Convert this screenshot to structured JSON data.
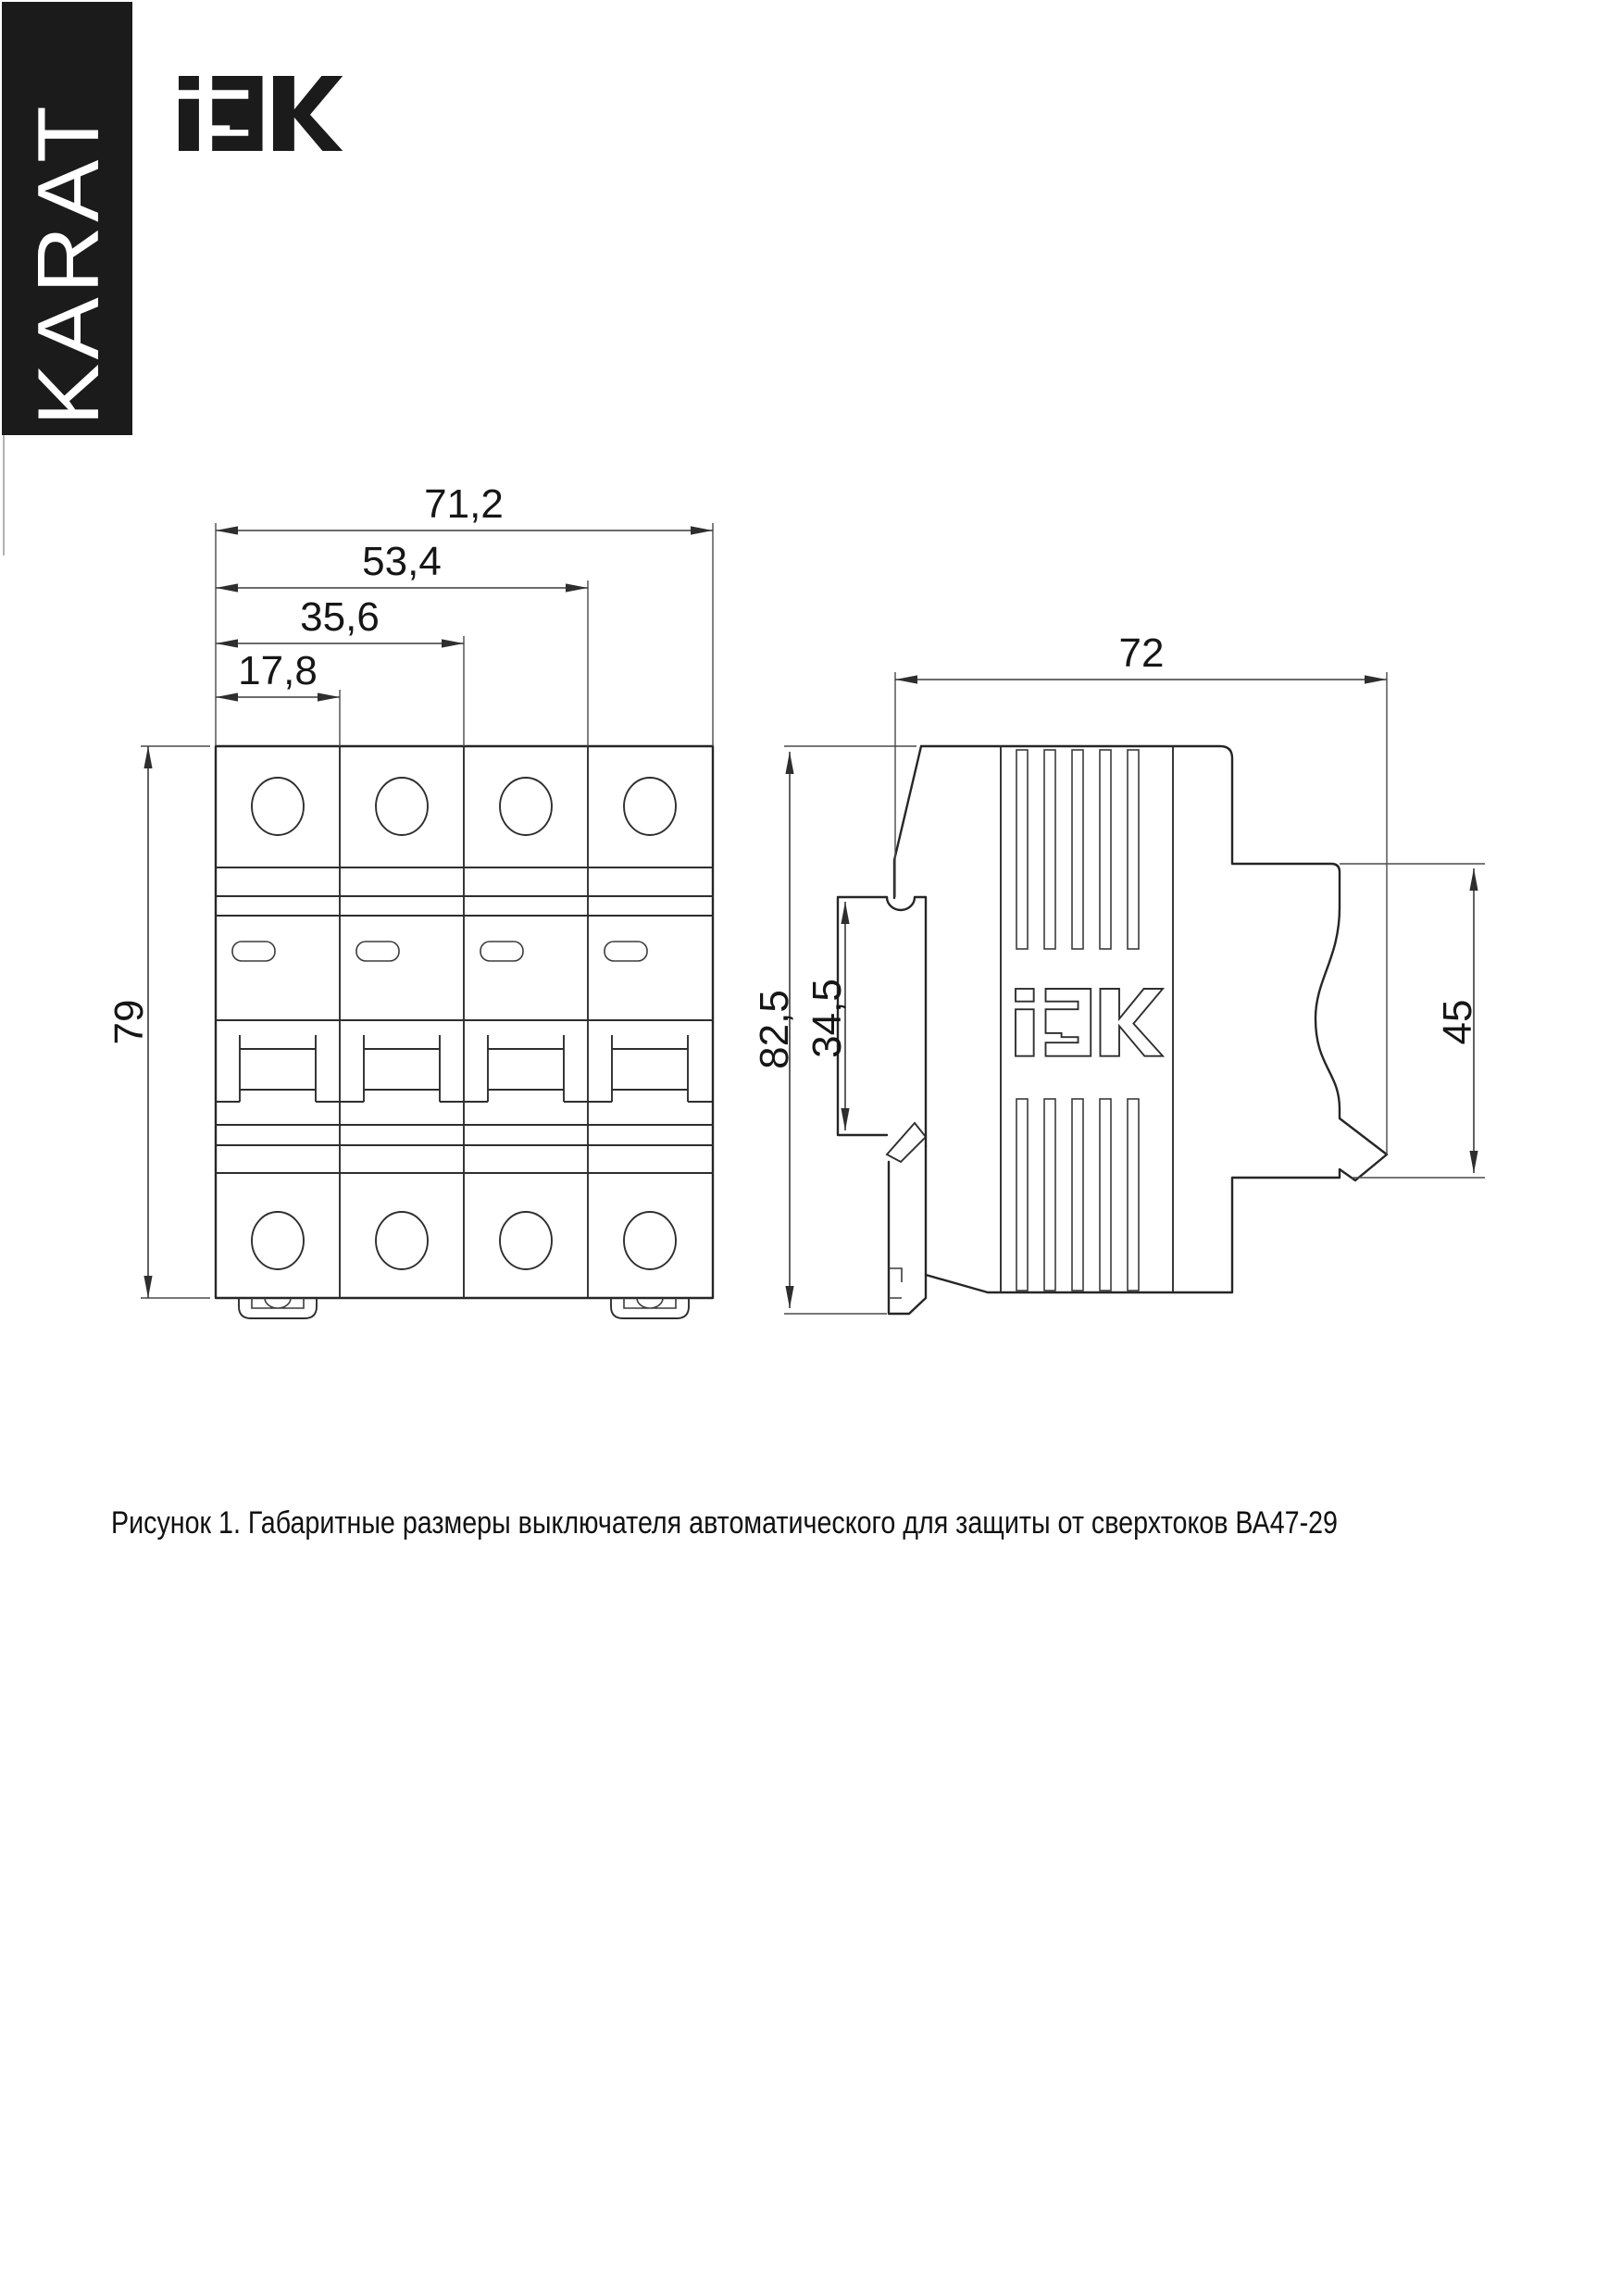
{
  "brand": {
    "karat_label": "KARAT",
    "iek_label": "IEK",
    "bar_color": "#1b1b1b"
  },
  "figure_caption": "Рисунок 1. Габаритные размеры выключателя автоматического для защиты от сверхтоков ВА47-29",
  "front_view": {
    "dim_total_width": "71,2",
    "dim_three_modules": "53,4",
    "dim_two_modules": "35,6",
    "dim_one_module": "17,8",
    "dim_height": "79"
  },
  "side_view": {
    "dim_depth": "72",
    "dim_total_height": "82,5",
    "dim_din_channel": "34,5",
    "dim_rear_recess": "45"
  },
  "colors": {
    "line": "#262626",
    "dim_line": "#3a3a3a",
    "text": "#161616",
    "background": "#ffffff"
  }
}
